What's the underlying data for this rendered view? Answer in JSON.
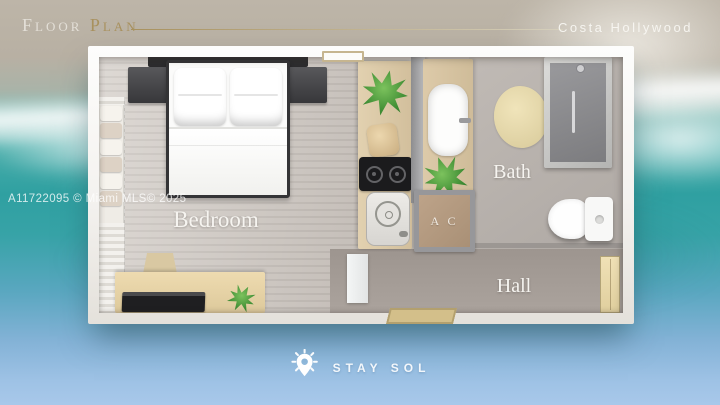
{
  "header": {
    "title_word1": "Floor",
    "title_word2": "Plan",
    "property_name": "Costa Hollywood"
  },
  "watermark": {
    "text": "A11722095 © Miami MLS© 2025"
  },
  "floor_plan": {
    "labels": {
      "bedroom": "Bedroom",
      "bath": "Bath",
      "hall": "Hall",
      "ac_closet": "A C"
    },
    "furniture": [
      "double-bed",
      "headboard",
      "nightstands",
      "closet-towels",
      "curtain",
      "desk",
      "desk-chair",
      "tv-console",
      "kitchen-counter",
      "cooktop",
      "kitchen-sink",
      "storage-basket",
      "vanity-sink",
      "shower",
      "toilet",
      "bath-rug",
      "entry-mat",
      "interior-door",
      "entry-door",
      "window",
      "potted-plants"
    ]
  },
  "footer": {
    "brand": "STAY SOL",
    "brand_icon": "sun-location-pin-icon"
  },
  "colors": {
    "accent_gold": "#a8915e",
    "title_white": "#e3dfd7",
    "label_white": "#f6f4f0",
    "ocean_teal": "#2fa2a3",
    "sky_blue": "#9fc2e5",
    "sand_beige": "#bab2a5",
    "counter_beige": "#dbc8a6",
    "ac_tan": "#b59c82"
  }
}
